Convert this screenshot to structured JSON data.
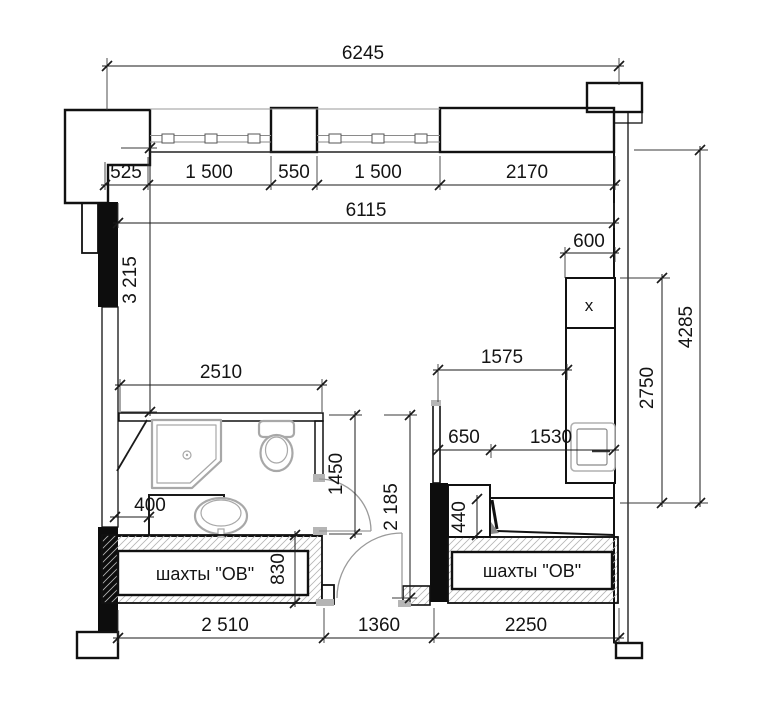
{
  "drawing": {
    "type": "apartment floor plan",
    "units": "mm",
    "language": "ru"
  },
  "dims": {
    "top_total": "6245",
    "window_row": [
      "525",
      "1 500",
      "550",
      "1 500",
      "2170"
    ],
    "interior_width": "6115",
    "counter_depth": "600",
    "left_height": "3 215",
    "right_total_height": "4285",
    "kitchen_zone_height": "2750",
    "kitchen_run": "1575",
    "bathroom_width": "2510",
    "hall_segments": [
      "650",
      "1530"
    ],
    "bathroom_depth": "1450",
    "hall_depth": "2 185",
    "bathroom_cabinet": "400",
    "bench_depth": "440",
    "shaft_depth": "830",
    "bottom_row": [
      "2 510",
      "1360",
      "2250"
    ]
  },
  "labels": {
    "shaft_left": "шахты \"ОВ\"",
    "shaft_right": "шахты \"ОВ\"",
    "kitchen_mark": "x"
  },
  "colors": {
    "wall_line": "#111111",
    "hatch": "#8f8f8f",
    "hatch_light": "#b5b5b5",
    "fixture_gray": "#a8a8a8",
    "column_fill": "#0d0d0d",
    "background": "#ffffff"
  }
}
